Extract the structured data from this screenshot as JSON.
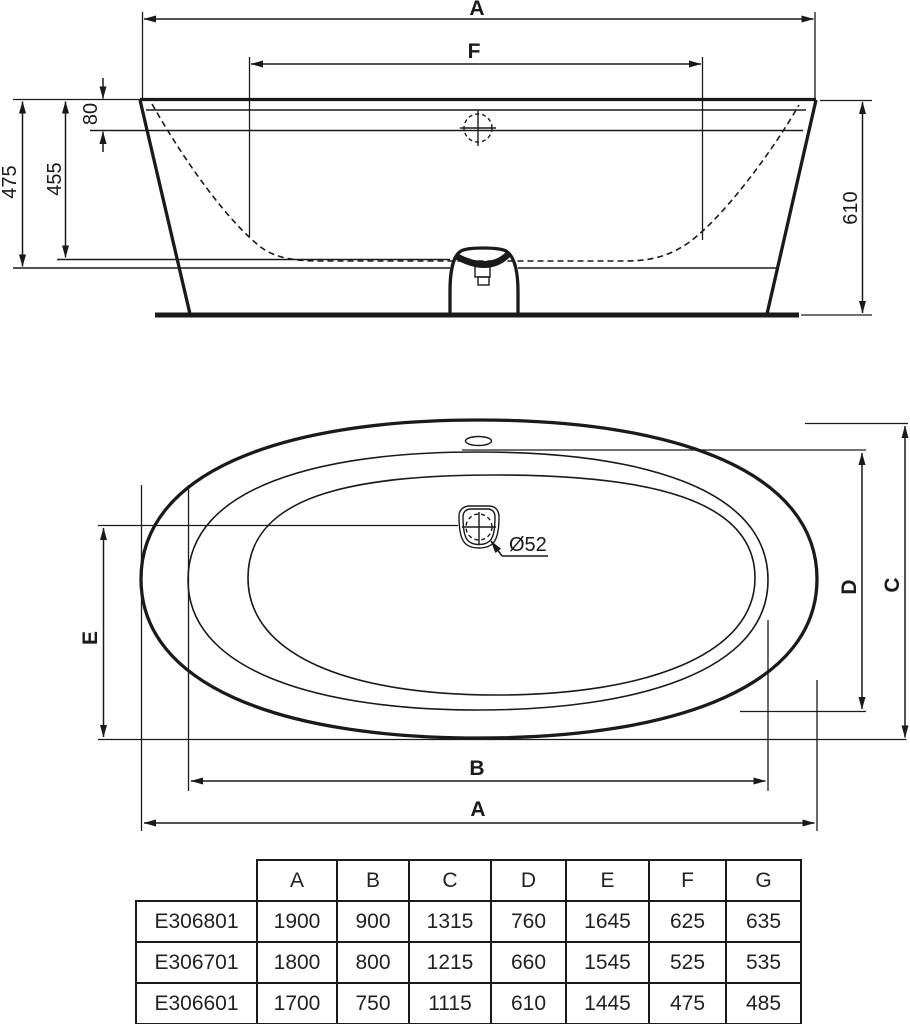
{
  "drawing": {
    "elevation": {
      "label_a": "A",
      "label_f": "F",
      "dim_80": "80",
      "dim_455": "455",
      "dim_475": "475",
      "dim_610": "610"
    },
    "plan": {
      "label_a": "A",
      "label_b": "B",
      "label_c": "C",
      "label_d": "D",
      "label_e": "E",
      "drain_diameter": "Ø52"
    }
  },
  "table": {
    "headers": [
      "A",
      "B",
      "C",
      "D",
      "E",
      "F",
      "G"
    ],
    "rows": [
      {
        "code": "E306801",
        "values": [
          "1900",
          "900",
          "1315",
          "760",
          "1645",
          "625",
          "635"
        ]
      },
      {
        "code": "E306701",
        "values": [
          "1800",
          "800",
          "1215",
          "660",
          "1545",
          "525",
          "535"
        ]
      },
      {
        "code": "E306601",
        "values": [
          "1700",
          "750",
          "1115",
          "610",
          "1445",
          "475",
          "485"
        ]
      }
    ]
  },
  "colors": {
    "line": "#1a1a1a",
    "background": "#ffffff"
  }
}
